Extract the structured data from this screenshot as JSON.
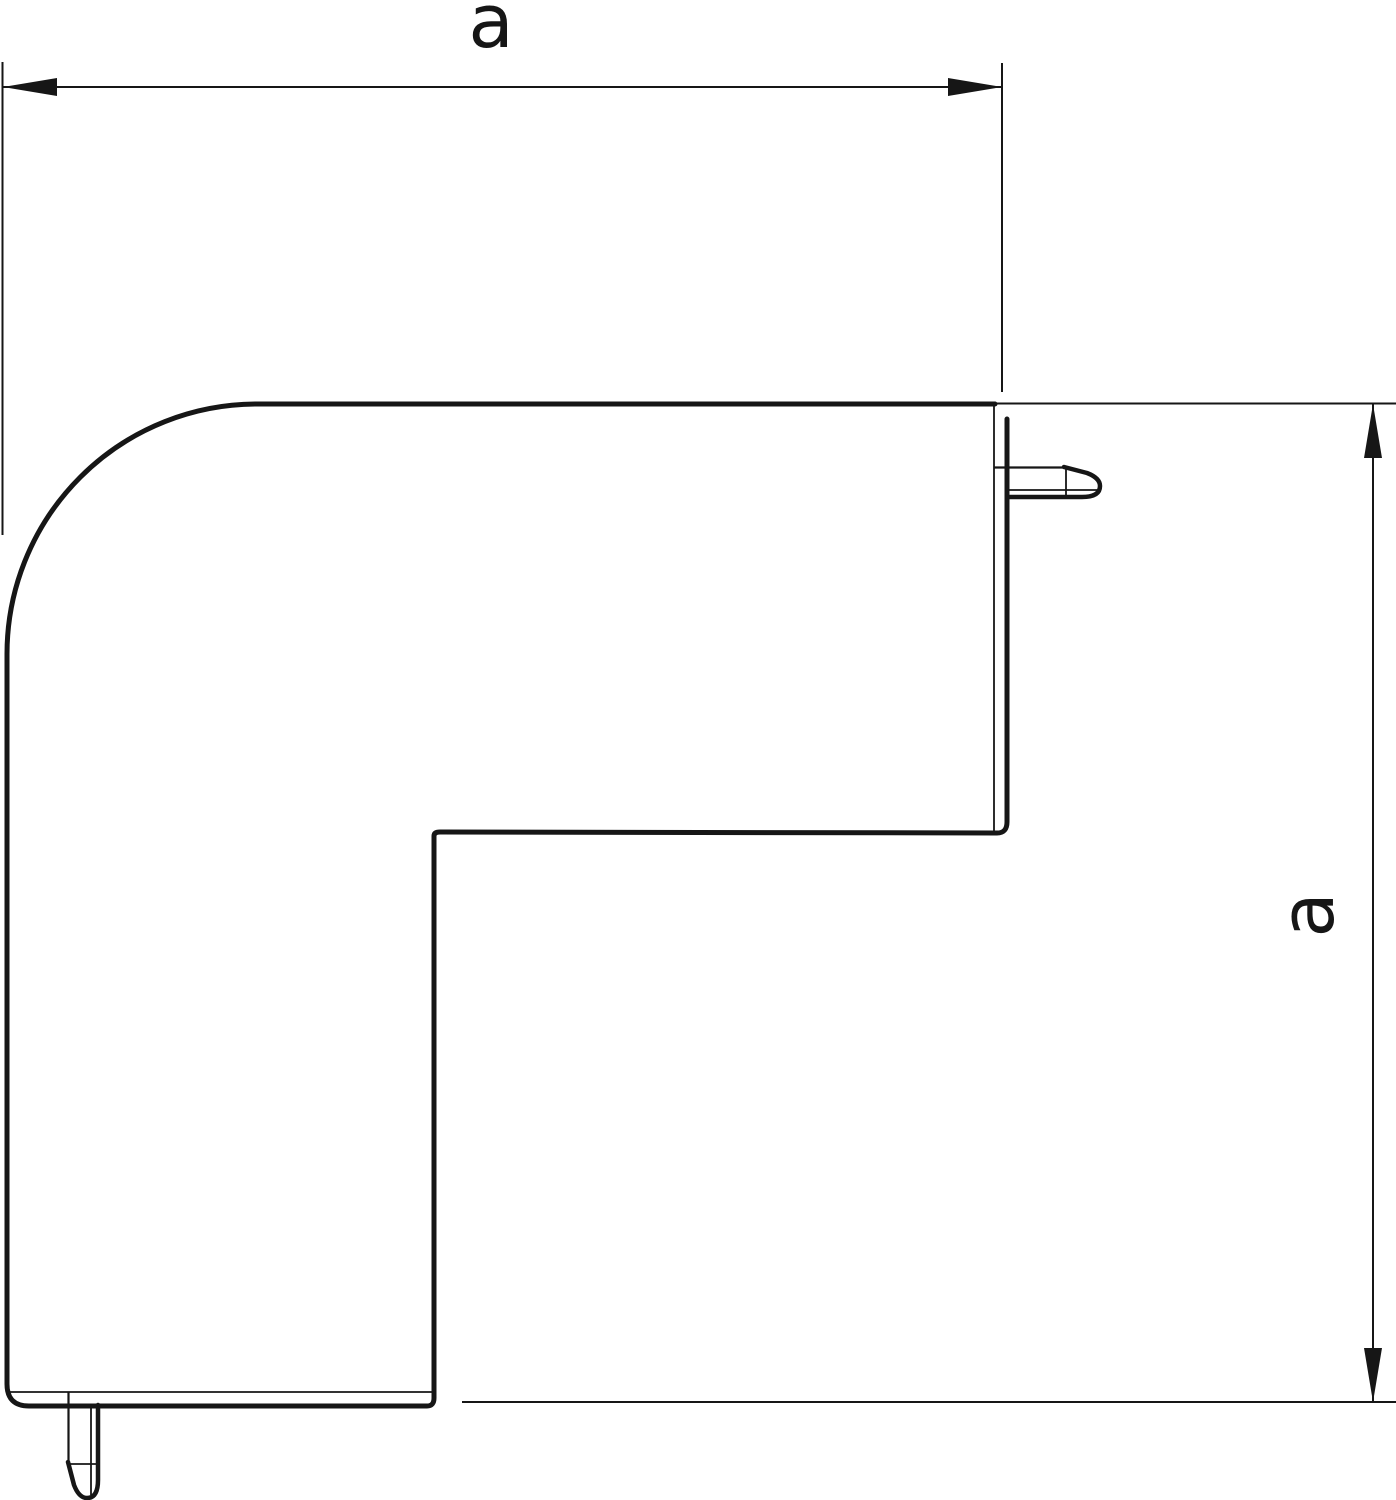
{
  "drawing": {
    "kind": "technical-dimension-drawing",
    "subject": "flat angle corner cover profile with latch tabs",
    "background_color": "#ffffff",
    "stroke_color": "#161616",
    "dimensions": {
      "width": {
        "label": "a"
      },
      "height": {
        "label": "a"
      }
    }
  }
}
